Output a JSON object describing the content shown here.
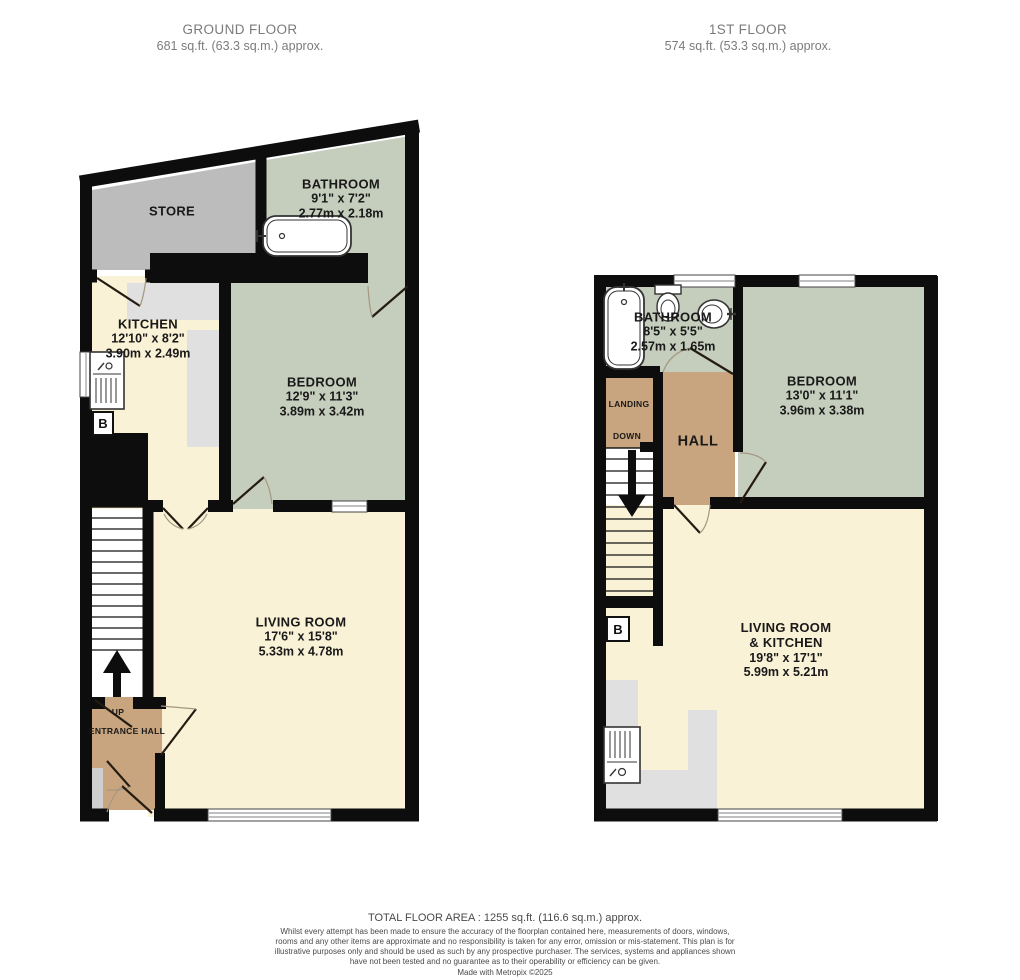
{
  "headers": {
    "ground": {
      "title": "GROUND FLOOR",
      "area": "681 sq.ft. (63.3 sq.m.) approx."
    },
    "first": {
      "title": "1ST FLOOR",
      "area": "574 sq.ft. (53.3 sq.m.) approx."
    }
  },
  "colors": {
    "wall": "#0d0d0d",
    "store_fill": "#bcbcbc",
    "sage_fill": "#c5cdbc",
    "cream_fill": "#f9f2d7",
    "tan_fill": "#c8a57e",
    "counter_fill": "#e0e0e0",
    "header_text": "#7b7b7b",
    "label_text": "#191919"
  },
  "ground_floor": {
    "rooms": [
      {
        "id": "store",
        "name": "STORE"
      },
      {
        "id": "bathroom",
        "name": "BATHROOM",
        "dim_ft": "9'1\"  x 7'2\"",
        "dim_m": "2.77m  x 2.18m"
      },
      {
        "id": "kitchen",
        "name": "KITCHEN",
        "dim_ft": "12'10\"  x 8'2\"",
        "dim_m": "3.90m  x 2.49m"
      },
      {
        "id": "bedroom",
        "name": "BEDROOM",
        "dim_ft": "12'9\"  x 11'3\"",
        "dim_m": "3.89m  x 3.42m"
      },
      {
        "id": "living",
        "name": "LIVING ROOM",
        "dim_ft": "17'6\"  x 15'8\"",
        "dim_m": "5.33m  x 4.78m"
      },
      {
        "id": "entrance",
        "name": "ENTRANCE HALL"
      }
    ],
    "stairs_label": "UP",
    "boiler_label": "B"
  },
  "first_floor": {
    "rooms": [
      {
        "id": "bathroom",
        "name": "BATHROOM",
        "dim_ft": "8'5\"  x 5'5\"",
        "dim_m": "2.57m  x 1.65m"
      },
      {
        "id": "bedroom",
        "name": "BEDROOM",
        "dim_ft": "13'0\"  x 11'1\"",
        "dim_m": "3.96m  x 3.38m"
      },
      {
        "id": "landing",
        "name": "LANDING"
      },
      {
        "id": "hall",
        "name": "HALL"
      },
      {
        "id": "living",
        "name": "LIVING ROOM",
        "name2": "& KITCHEN",
        "dim_ft": "19'8\"  x 17'1\"",
        "dim_m": "5.99m  x 5.21m"
      }
    ],
    "stairs_label": "DOWN",
    "boiler_label": "B"
  },
  "footer": {
    "total": "TOTAL FLOOR AREA : 1255 sq.ft. (116.6 sq.m.) approx.",
    "disclaimer": "Whilst every attempt has been made to ensure the accuracy of the floorplan contained here, measurements of doors, windows, rooms and any other items are approximate and no responsibility is taken for any error, omission or mis-statement. This plan is for illustrative purposes only and should be used as such by any prospective purchaser. The services, systems and appliances shown have not been tested and no guarantee as to their operability or efficiency can be given.",
    "made_with": "Made with Metropix ©2025"
  }
}
